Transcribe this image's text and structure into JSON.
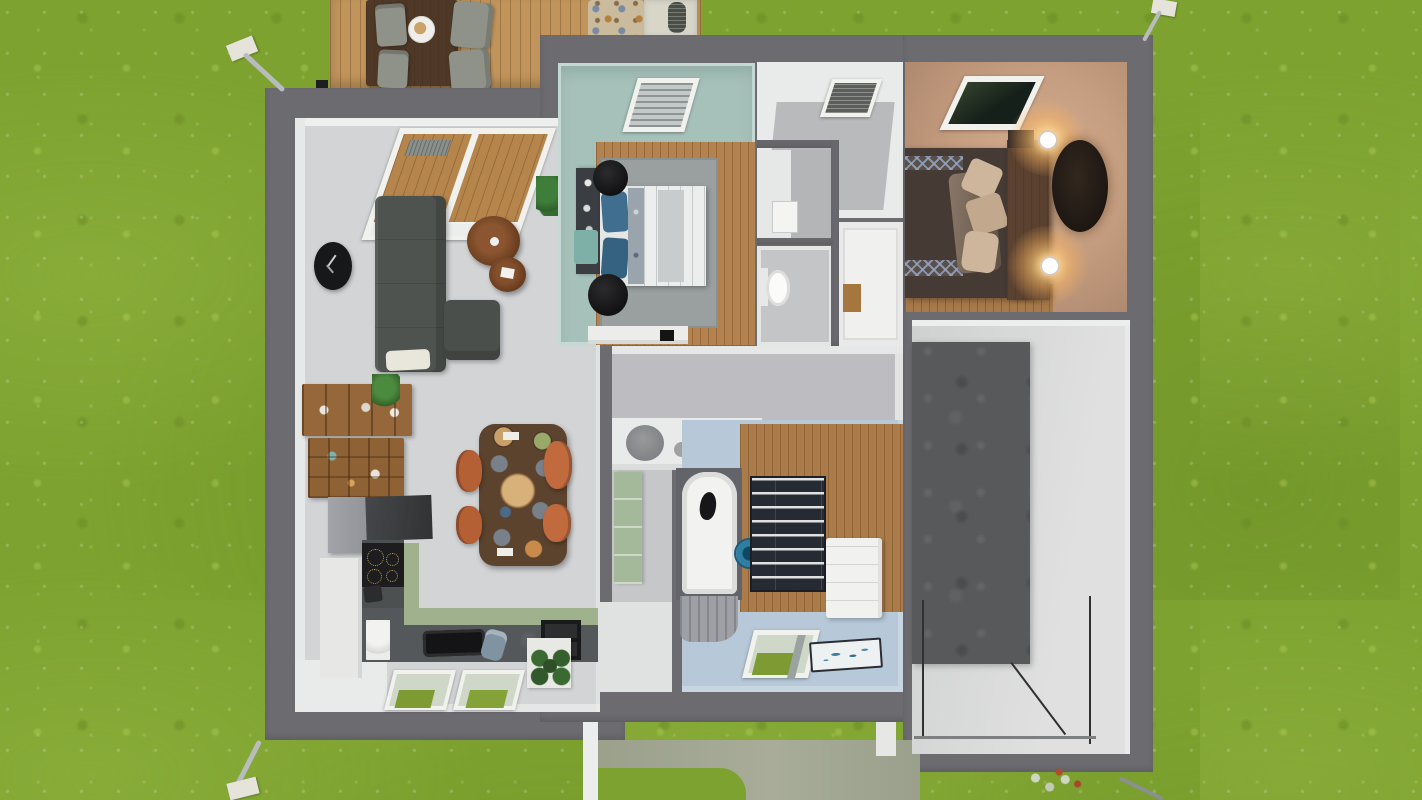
{
  "app": {
    "view": "3d-floorplan-aerial-render",
    "text_visible": false
  },
  "palette": {
    "grass": "#7da22f",
    "grass-light": "#a9c257",
    "wall": "#6b6b70",
    "deck-wood": "#c0945a",
    "deck-table": "#4e3827",
    "living-floor": "#d3d4d6",
    "white-wall": "#e9ebeb",
    "sofa": "#4f534f",
    "clock": "#17181a",
    "wood-table": "#7b4a28",
    "dining-table": "#5c432e",
    "chair-rust": "#b55f35",
    "chair-gray": "#8f9288",
    "shelf-wood": "#96673a",
    "counter-dark": "#4d5051",
    "cabinet-green": "#9fb28d",
    "cabinet-white": "#e7e8e6",
    "cooktop": "#1d1d1f",
    "teal-wall": "#a6c0ba",
    "bedroom-wood": "#b3824f",
    "rug-gray": "#9aa0a0",
    "headboard-dark": "#3a3d42",
    "ottoman-teal": "#7fb0a8",
    "pillow-blue": "#3f6e8e",
    "warm-wall": "#c9a287",
    "warm-glow": "#f3c98e",
    "bed-dark": "#463a34",
    "pillow-beige": "#cdb69c",
    "headboard-wood": "#5a4130",
    "rug-dark": "#241c17",
    "hall-floor": "#bdbdc1",
    "basin-gray": "#8d9092",
    "bath-floor": "#b7c9d9",
    "tub-white": "#f2f2f0",
    "bucket-blue": "#2f7fa3",
    "rug-navy": "#252a33",
    "dresser-white": "#f1f1ef",
    "mat-white": "#eef1f2",
    "pantry-green": "#a4b999",
    "storage-floor": "#d6d6d6",
    "storage-dark": "#57595a",
    "path": "#9da289",
    "pipe": "#b9bcbe",
    "window-frame": "#f1f1ee",
    "glass-green": "#cfd8c8",
    "grass-through": "#7d9a33",
    "wardrobe-white": "#f0f0ee"
  },
  "scene": {
    "environment": [
      "lawn-grass",
      "concrete-entrance-path",
      "rain-downspouts",
      "garden-hose"
    ],
    "exterior": {
      "deck": [
        "wood-plank-deck",
        "outdoor-dining-table",
        "outdoor-chairs-x4",
        "food-plate",
        "pebble-rug",
        "stone-pad",
        "grill"
      ]
    },
    "rooms": [
      {
        "id": "living-kitchen",
        "floor": "light-gray",
        "items": [
          "sloped-roof-window-over-deck",
          "l-shaped-sofa",
          "white-cushion",
          "wall-clock-black-oval",
          "round-coffee-table-large",
          "round-coffee-table-small",
          "potted-plant",
          "wall-shelf-unit-wood",
          "dining-table-dark-wood",
          "rust-chairs-x4",
          "tall-gray-unit",
          "cooktop-black",
          "l-shaped-counter-green-front",
          "white-tall-cabinet",
          "kettle",
          "black-tray",
          "mixer",
          "double-sink-black",
          "plant-on-cabinet",
          "floor-roof-windows-x2"
        ]
      },
      {
        "id": "teal-bedroom",
        "walls": "teal",
        "floor": "oak",
        "items": [
          "roof-window-blinds",
          "area-rug-gray",
          "double-bed-white-bedding",
          "blue-pillows",
          "headboard-shelf-dark",
          "teal-ottoman",
          "black-round-stools-x2",
          "low-dresser-white",
          "tv-small"
        ]
      },
      {
        "id": "landing",
        "items": [
          "roof-vent-window"
        ]
      },
      {
        "id": "hall-nook",
        "items": [
          "white-sink-box"
        ]
      },
      {
        "id": "wc",
        "items": [
          "toilet"
        ]
      },
      {
        "id": "closet",
        "items": [
          "white-wardrobe",
          "wood-drawer"
        ]
      },
      {
        "id": "warm-bedroom",
        "lighting": "warm-sconces",
        "items": [
          "roof-window-dark",
          "double-bed-dark-duvet",
          "zigzag-runner-bands",
          "beige-pillows",
          "wood-headboard",
          "wall-sconces-lit-x2",
          "oval-rug-dark",
          "wood-floor-strip"
        ]
      },
      {
        "id": "hallway",
        "items": [
          "vanity-counter",
          "round-basin-gray",
          "towel-gray"
        ]
      },
      {
        "id": "pantry",
        "items": [
          "green-shelf-unit"
        ]
      },
      {
        "id": "bathroom",
        "floor": "light-blue",
        "items": [
          "bathtub-white",
          "cat-in-tub",
          "blue-bucket",
          "gray-curtain",
          "wavy-rug-navy",
          "wood-dressing-floor",
          "dresser-white",
          "floor-roof-window",
          "bath-mat-fish"
        ]
      },
      {
        "id": "storage-room",
        "items": [
          "dark-concrete-area",
          "metal-glass-railing"
        ]
      }
    ]
  }
}
